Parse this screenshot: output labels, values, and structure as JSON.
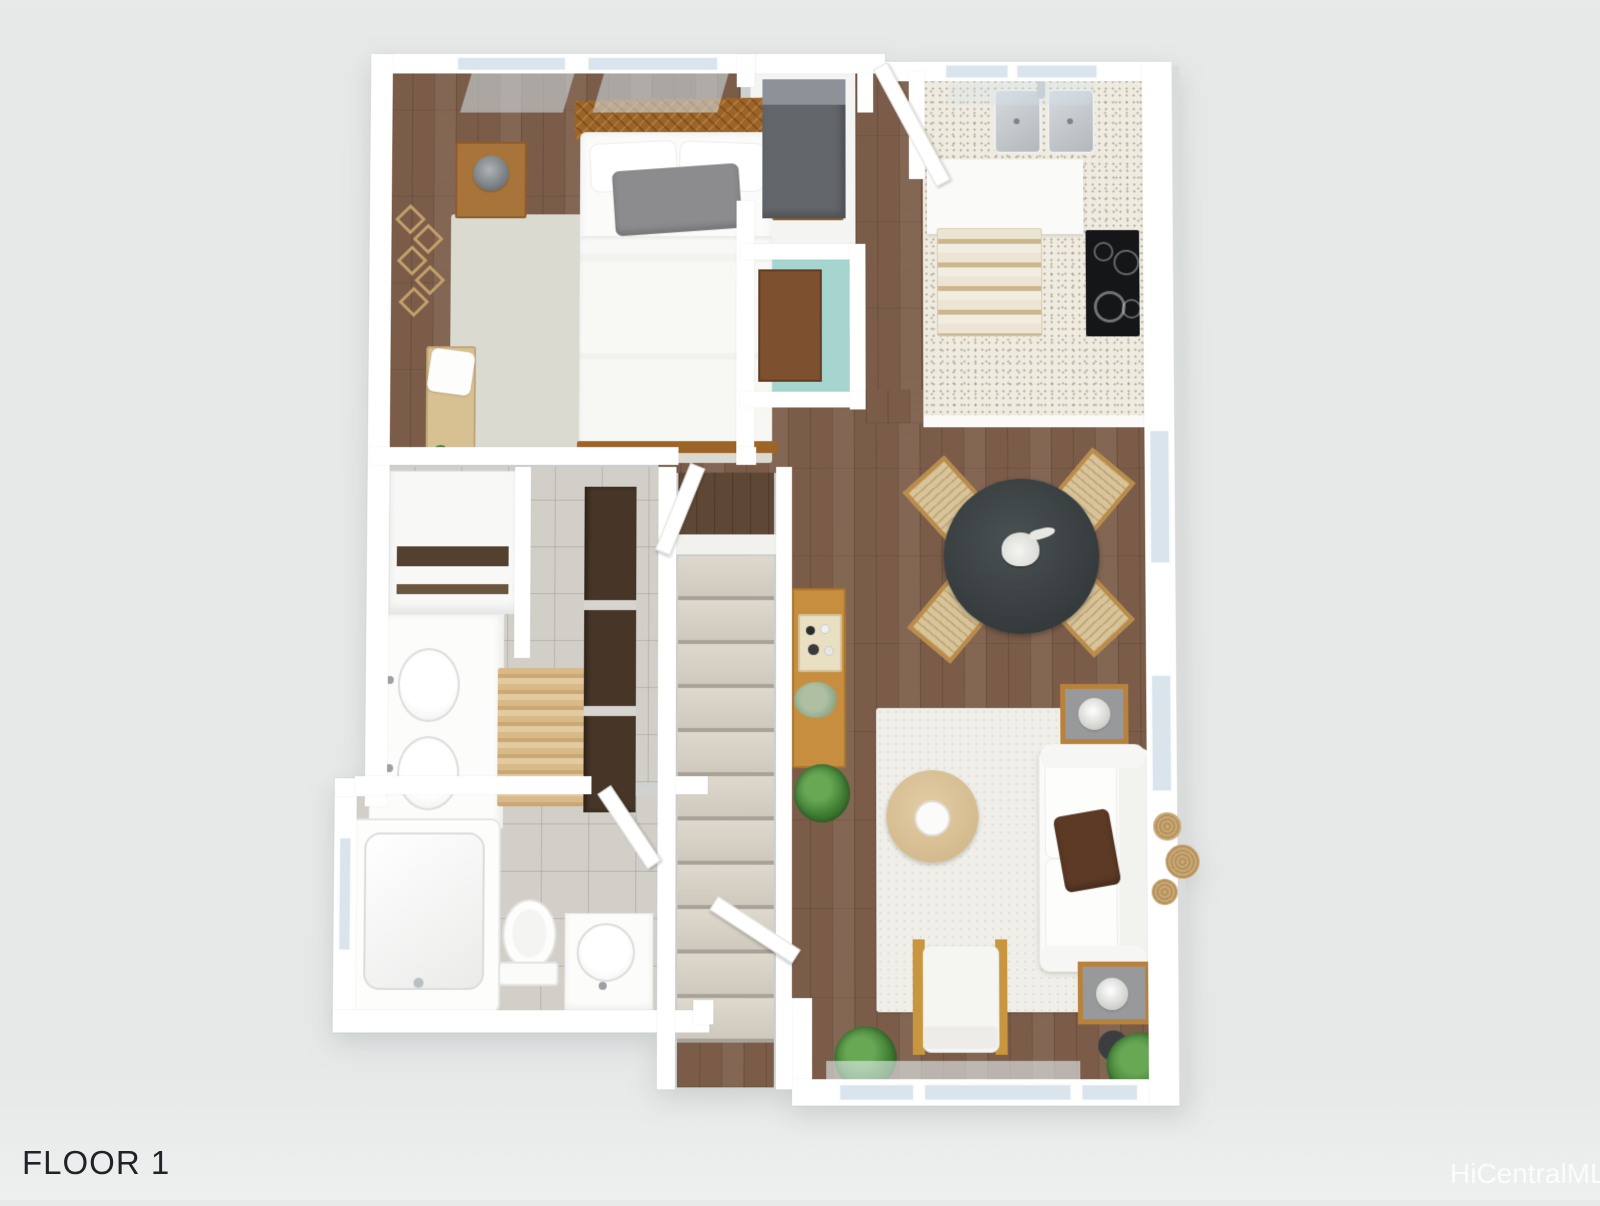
{
  "labels": {
    "floor_label": "FLOOR 1",
    "watermark": "HiCentralMLS"
  },
  "colors": {
    "background": "#e7e9e9",
    "walls": "#ffffff",
    "wood_floor": "#7a5c49",
    "dark_wood_landing": "#5e4735",
    "tile_floor": "#d2cfc9",
    "granite_counter": "#efebe0",
    "window_glass": "#d9e4ec",
    "teal_accent_nook": "#a6d5d0",
    "stair_carpet": "#d5cfc4",
    "bed_frame_wood": "#9d6427",
    "nightstand_wood": "#a8743a",
    "gray_pillow": "#8c8c8e",
    "brown_sofa_pillow": "#5c3a26",
    "dining_table": "#3b4143",
    "chair_seat": "#d8c498",
    "console_wood": "#c68e3e",
    "coffee_table": "#d9c097",
    "cooktop": "#141617",
    "appliance_gray": "#63676c",
    "plant_green": "#3f7d33"
  },
  "legend": {
    "rooms": [
      "bedroom",
      "closet-laundry",
      "accent-nook",
      "kitchen",
      "dining-area",
      "living-area",
      "hallway",
      "master-bathroom",
      "second-bathroom",
      "staircase",
      "entry"
    ],
    "furniture": [
      "bed",
      "nightstand",
      "table-lamp",
      "bench",
      "wall-art",
      "washer-appliance",
      "double-sink",
      "cooktop",
      "kitchen-rug",
      "dining-table",
      "dining-chair",
      "pineapple-centerpiece",
      "console-table",
      "sofa",
      "brown-pillow",
      "coffee-table",
      "side-table",
      "accent-chair",
      "area-rug",
      "potted-plant",
      "jute-wall-decor",
      "double-vanity",
      "linen-closet",
      "wardrobe",
      "bathtub",
      "toilet",
      "vanity-sink",
      "stairs",
      "door",
      "window"
    ]
  }
}
